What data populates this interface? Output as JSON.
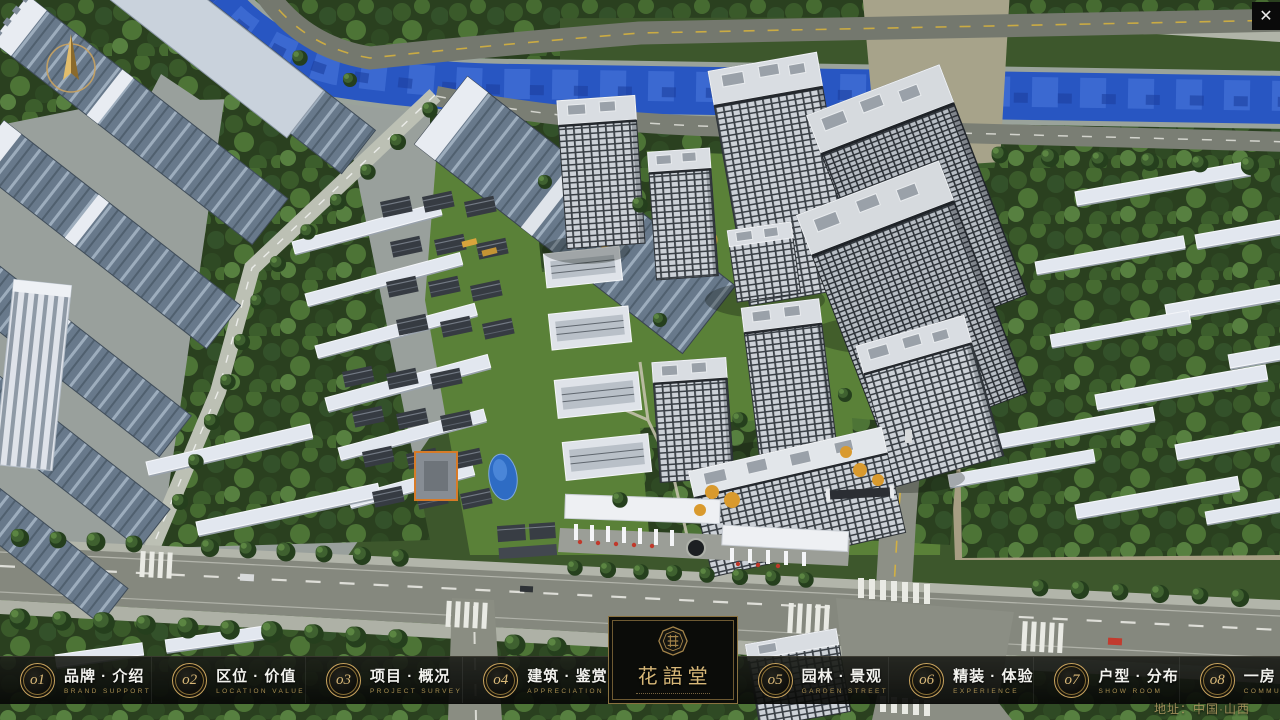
{
  "navbar": {
    "items": [
      {
        "num": "o1",
        "zh": "品牌 · 介绍",
        "en": "BRAND SUPPORT"
      },
      {
        "num": "o2",
        "zh": "区位 · 价值",
        "en": "LOCATION VALUE"
      },
      {
        "num": "o3",
        "zh": "项目 · 概况",
        "en": "PROJECT SURVEY"
      },
      {
        "num": "o4",
        "zh": "建筑 · 鉴赏",
        "en": "APPRECIATION"
      },
      {
        "num": "o5",
        "zh": "园林 · 景观",
        "en": "GARDEN STREET"
      },
      {
        "num": "o6",
        "zh": "精装 · 体验",
        "en": "EXPERIENCE"
      },
      {
        "num": "o7",
        "zh": "户型 · 分布",
        "en": "SHOW ROOM"
      },
      {
        "num": "o8",
        "zh": "一房 · 一景",
        "en": "COMMUNITY"
      }
    ]
  },
  "logo": {
    "title": "花語堂"
  },
  "footer": {
    "address": "地址：中国·山西"
  },
  "window": {
    "close_label": "✕"
  },
  "colors": {
    "gold": "#c8a35e",
    "gold_dark": "#8a7036",
    "bar_bg": "#0b0c09",
    "river": "#2856c2"
  }
}
